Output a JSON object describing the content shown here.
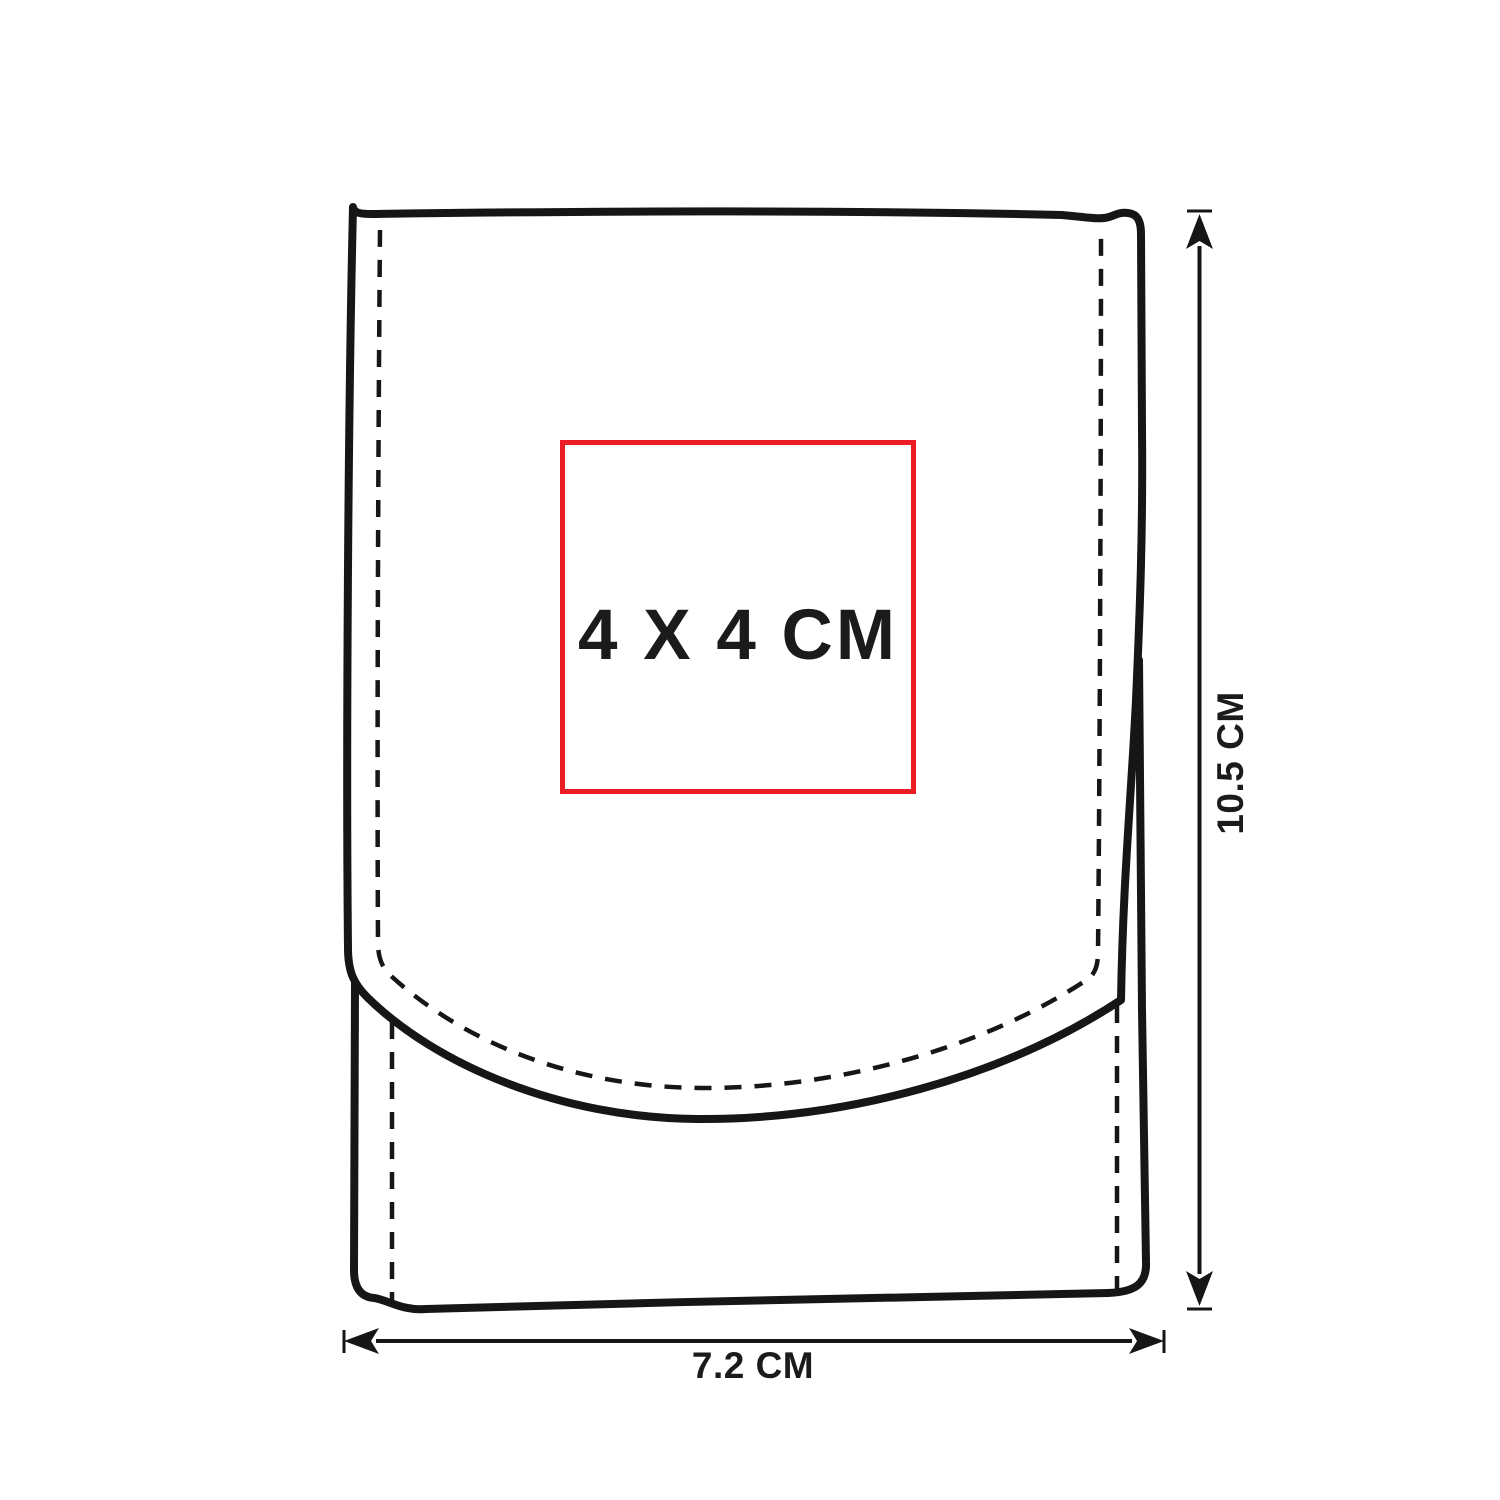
{
  "diagram": {
    "print_area": {
      "label": "4 X 4 CM"
    },
    "dimensions": {
      "height_label": "10.5 CM",
      "width_label": "7.2 CM"
    },
    "colors": {
      "line": "#161616",
      "print_area_border": "#ec1c24",
      "background": "#ffffff"
    }
  }
}
